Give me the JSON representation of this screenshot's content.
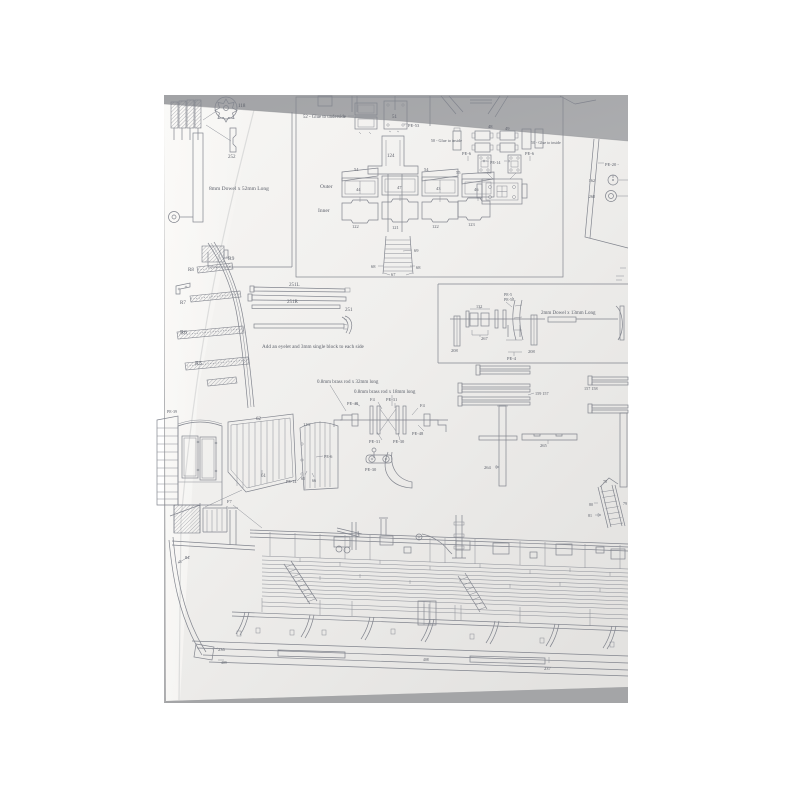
{
  "sheet": {
    "description": "photographed model-ship plan sheet",
    "colors": {
      "photo_background": "#a8a9ac",
      "paper": "#f2f1ef",
      "ink": "#82858e",
      "text": "#5d616b"
    },
    "labels": [
      {
        "name": "part-label-118",
        "text": "118",
        "x": 238,
        "y": 107
      },
      {
        "name": "part-label-252",
        "text": "252",
        "x": 228,
        "y": 158
      },
      {
        "name": "instruction-dowel-8mm",
        "text": "8mm Dowel x 52mm Long",
        "x": 209,
        "y": 190,
        "fs": 5.5
      },
      {
        "name": "instruction-52-glue-underside",
        "text": "52 - Glue to underside",
        "x": 303,
        "y": 118,
        "fs": 4.8
      },
      {
        "name": "part-label-51",
        "text": "51",
        "x": 392,
        "y": 118
      },
      {
        "name": "part-label-pe53",
        "text": "PE-53",
        "x": 408,
        "y": 127,
        "fs": 4.5
      },
      {
        "name": "part-label-124",
        "text": "124",
        "x": 387,
        "y": 157
      },
      {
        "name": "part-label-54a",
        "text": "54",
        "x": 354,
        "y": 171,
        "fs": 4.5
      },
      {
        "name": "part-label-54b",
        "text": "54",
        "x": 424,
        "y": 171,
        "fs": 4.5
      },
      {
        "name": "part-label-55",
        "text": "55",
        "x": 456,
        "y": 174,
        "fs": 4.5
      },
      {
        "name": "caption-outer",
        "text": "Outer",
        "x": 320,
        "y": 188,
        "fs": 5.5
      },
      {
        "name": "caption-inner",
        "text": "Inner",
        "x": 318,
        "y": 212,
        "fs": 5.5
      },
      {
        "name": "part-label-44",
        "text": "44",
        "x": 356,
        "y": 191,
        "fs": 4.5
      },
      {
        "name": "part-label-47",
        "text": "47",
        "x": 397,
        "y": 189,
        "fs": 4.5
      },
      {
        "name": "part-label-43",
        "text": "43",
        "x": 436,
        "y": 190,
        "fs": 4.5
      },
      {
        "name": "part-label-46",
        "text": "46",
        "x": 474,
        "y": 191,
        "fs": 4.5
      },
      {
        "name": "part-label-122a",
        "text": "122",
        "x": 352,
        "y": 228,
        "fs": 4.5
      },
      {
        "name": "part-label-121",
        "text": "121",
        "x": 392,
        "y": 229,
        "fs": 4.5
      },
      {
        "name": "part-label-122b",
        "text": "122",
        "x": 432,
        "y": 228,
        "fs": 4.5
      },
      {
        "name": "part-label-123",
        "text": "123",
        "x": 468,
        "y": 226,
        "fs": 4.5
      },
      {
        "name": "part-label-69",
        "text": "69",
        "x": 414,
        "y": 252,
        "fs": 4.5
      },
      {
        "name": "part-label-68a",
        "text": "68",
        "x": 371,
        "y": 268,
        "fs": 4.5
      },
      {
        "name": "part-label-68b",
        "text": "68",
        "x": 416,
        "y": 269,
        "fs": 4.5
      },
      {
        "name": "part-label-67",
        "text": "67",
        "x": 391,
        "y": 276,
        "fs": 4.5
      },
      {
        "name": "part-label-48",
        "text": "48",
        "x": 488,
        "y": 128,
        "fs": 4.5
      },
      {
        "name": "part-label-49",
        "text": "49",
        "x": 505,
        "y": 130,
        "fs": 4.5
      },
      {
        "name": "instruction-50-glue-inside-left",
        "text": "50 - Glue to inside",
        "x": 462,
        "y": 142,
        "fs": 4.2,
        "anchor": "end"
      },
      {
        "name": "instruction-50-glue-inside-right",
        "text": "50 - Glue to inside",
        "x": 531,
        "y": 144,
        "fs": 4
      },
      {
        "name": "part-label-pe6-left",
        "text": "PE-6",
        "x": 462,
        "y": 155,
        "fs": 4.5
      },
      {
        "name": "part-label-pe6-right",
        "text": "PE-6",
        "x": 525,
        "y": 155,
        "fs": 4.5
      },
      {
        "name": "part-label-pe14-top",
        "text": "PE-14",
        "x": 490,
        "y": 164,
        "fs": 4.2
      },
      {
        "name": "part-label-pe20",
        "text": "PE-20 -",
        "x": 605,
        "y": 166,
        "fs": 4.5
      },
      {
        "name": "part-label-162",
        "text": "162",
        "x": 595,
        "y": 182,
        "fs": 4.2,
        "anchor": "end"
      },
      {
        "name": "part-label-268",
        "text": "268",
        "x": 595,
        "y": 198,
        "fs": 4.2,
        "anchor": "end"
      },
      {
        "name": "part-label-r9",
        "text": "R9",
        "x": 228,
        "y": 260,
        "fs": 5.5
      },
      {
        "name": "part-label-r8",
        "text": "R8",
        "x": 188,
        "y": 271,
        "fs": 5
      },
      {
        "name": "part-label-r7",
        "text": "R7",
        "x": 180,
        "y": 304,
        "fs": 5
      },
      {
        "name": "part-label-r6",
        "text": "R6",
        "x": 180,
        "y": 334,
        "fs": 6
      },
      {
        "name": "part-label-r5",
        "text": "R5",
        "x": 195,
        "y": 365,
        "fs": 6
      },
      {
        "name": "part-label-251L",
        "text": "251L",
        "x": 289,
        "y": 286
      },
      {
        "name": "part-label-251R",
        "text": "251R",
        "x": 287,
        "y": 303
      },
      {
        "name": "part-label-251",
        "text": "251",
        "x": 345,
        "y": 311
      },
      {
        "name": "instruction-eyelet-block",
        "text": "Add an eyelet and 3mm single block to each side",
        "x": 262,
        "y": 348,
        "fs": 5.2
      },
      {
        "name": "part-label-pe5",
        "text": "PE-5",
        "x": 504,
        "y": 296,
        "fs": 4
      },
      {
        "name": "part-label-pe50",
        "text": "PE-50",
        "x": 504,
        "y": 301,
        "fs": 4
      },
      {
        "name": "part-label-132",
        "text": "132",
        "x": 476,
        "y": 308,
        "fs": 4.2
      },
      {
        "name": "part-label-267",
        "text": "267",
        "x": 481,
        "y": 340,
        "fs": 4.5
      },
      {
        "name": "part-label-208-left",
        "text": "208",
        "x": 451,
        "y": 352,
        "fs": 4.5
      },
      {
        "name": "part-label-208-right",
        "text": "208",
        "x": 528,
        "y": 353,
        "fs": 4.5
      },
      {
        "name": "part-label-pe4",
        "text": "PE-4",
        "x": 507,
        "y": 360,
        "fs": 4.5
      },
      {
        "name": "instruction-dowel-2mm",
        "text": "2mm Dowel x 13mm Long",
        "x": 541,
        "y": 314,
        "fs": 5
      },
      {
        "name": "instruction-brassrod-32mm",
        "text": "0.8mm brass rod x 32mm long",
        "x": 317,
        "y": 383,
        "fs": 5
      },
      {
        "name": "instruction-brassrod-18mm",
        "text": "0.8mm brass rod x 18mm long",
        "x": 354,
        "y": 393,
        "fs": 5
      },
      {
        "name": "part-label-pe48-left",
        "text": "PE-48",
        "x": 347,
        "y": 405,
        "fs": 4.5
      },
      {
        "name": "part-label-f4-left",
        "text": "F4",
        "x": 370,
        "y": 401,
        "fs": 4.5
      },
      {
        "name": "part-label-pe31-top",
        "text": "PE-31",
        "x": 386,
        "y": 401,
        "fs": 4.5
      },
      {
        "name": "part-label-f4-right",
        "text": "F4",
        "x": 420,
        "y": 407,
        "fs": 4.5
      },
      {
        "name": "part-label-pe48-right",
        "text": "PE-48",
        "x": 412,
        "y": 435,
        "fs": 4.5
      },
      {
        "name": "part-label-pe31-bottom",
        "text": "PE-31",
        "x": 369,
        "y": 443,
        "fs": 4.5
      },
      {
        "name": "part-label-pe30-mid",
        "text": "PE-30",
        "x": 393,
        "y": 443,
        "fs": 4.5
      },
      {
        "name": "part-label-pe30-bottom",
        "text": "PE-30",
        "x": 365,
        "y": 471,
        "fs": 4.5
      },
      {
        "name": "part-label-pe39",
        "text": "PE-39",
        "x": 167,
        "y": 413,
        "fs": 4
      },
      {
        "name": "part-label-62",
        "text": "62",
        "x": 256,
        "y": 420
      },
      {
        "name": "part-label-61",
        "text": "61",
        "x": 261,
        "y": 477
      },
      {
        "name": "part-label-116",
        "text": "116",
        "x": 303,
        "y": 426,
        "fs": 4.5
      },
      {
        "name": "part-label-pe6-panel",
        "text": "PE-6",
        "x": 324,
        "y": 458,
        "fs": 4.2
      },
      {
        "name": "part-label-pe14-panel",
        "text": "PE-14",
        "x": 286,
        "y": 483,
        "fs": 4.2
      },
      {
        "name": "part-label-65",
        "text": "65",
        "x": 301,
        "y": 480,
        "fs": 4
      },
      {
        "name": "part-label-66",
        "text": "66",
        "x": 312,
        "y": 482,
        "fs": 4
      },
      {
        "name": "part-label-159-157",
        "text": "159  157",
        "x": 535,
        "y": 395,
        "fs": 4.2
      },
      {
        "name": "part-label-157-158",
        "text": "157  158",
        "x": 584,
        "y": 390,
        "fs": 4.2
      },
      {
        "name": "part-label-264",
        "text": "264",
        "x": 484,
        "y": 469,
        "fs": 4.5
      },
      {
        "name": "part-label-265",
        "text": "265",
        "x": 540,
        "y": 447,
        "fs": 4.5
      },
      {
        "name": "part-label-78",
        "text": "78",
        "x": 603,
        "y": 483,
        "fs": 4
      },
      {
        "name": "part-label-79",
        "text": "79",
        "x": 623,
        "y": 505,
        "fs": 4
      },
      {
        "name": "part-label-80",
        "text": "80",
        "x": 589,
        "y": 506,
        "fs": 4
      },
      {
        "name": "part-label-81",
        "text": "81",
        "x": 588,
        "y": 517,
        "fs": 4
      },
      {
        "name": "part-label-f7",
        "text": "F7",
        "x": 227,
        "y": 503,
        "fs": 4.5
      },
      {
        "name": "part-label-84",
        "text": "84",
        "x": 185,
        "y": 559,
        "fs": 4.5
      },
      {
        "name": "part-label-236",
        "text": "236",
        "x": 218,
        "y": 651,
        "fs": 4.5
      },
      {
        "name": "part-label-409",
        "text": "409",
        "x": 221,
        "y": 664,
        "fs": 3.8
      },
      {
        "name": "part-label-408",
        "text": "408",
        "x": 423,
        "y": 661,
        "fs": 3.8
      },
      {
        "name": "part-label-237",
        "text": "237",
        "x": 544,
        "y": 670,
        "fs": 4.5
      }
    ]
  }
}
